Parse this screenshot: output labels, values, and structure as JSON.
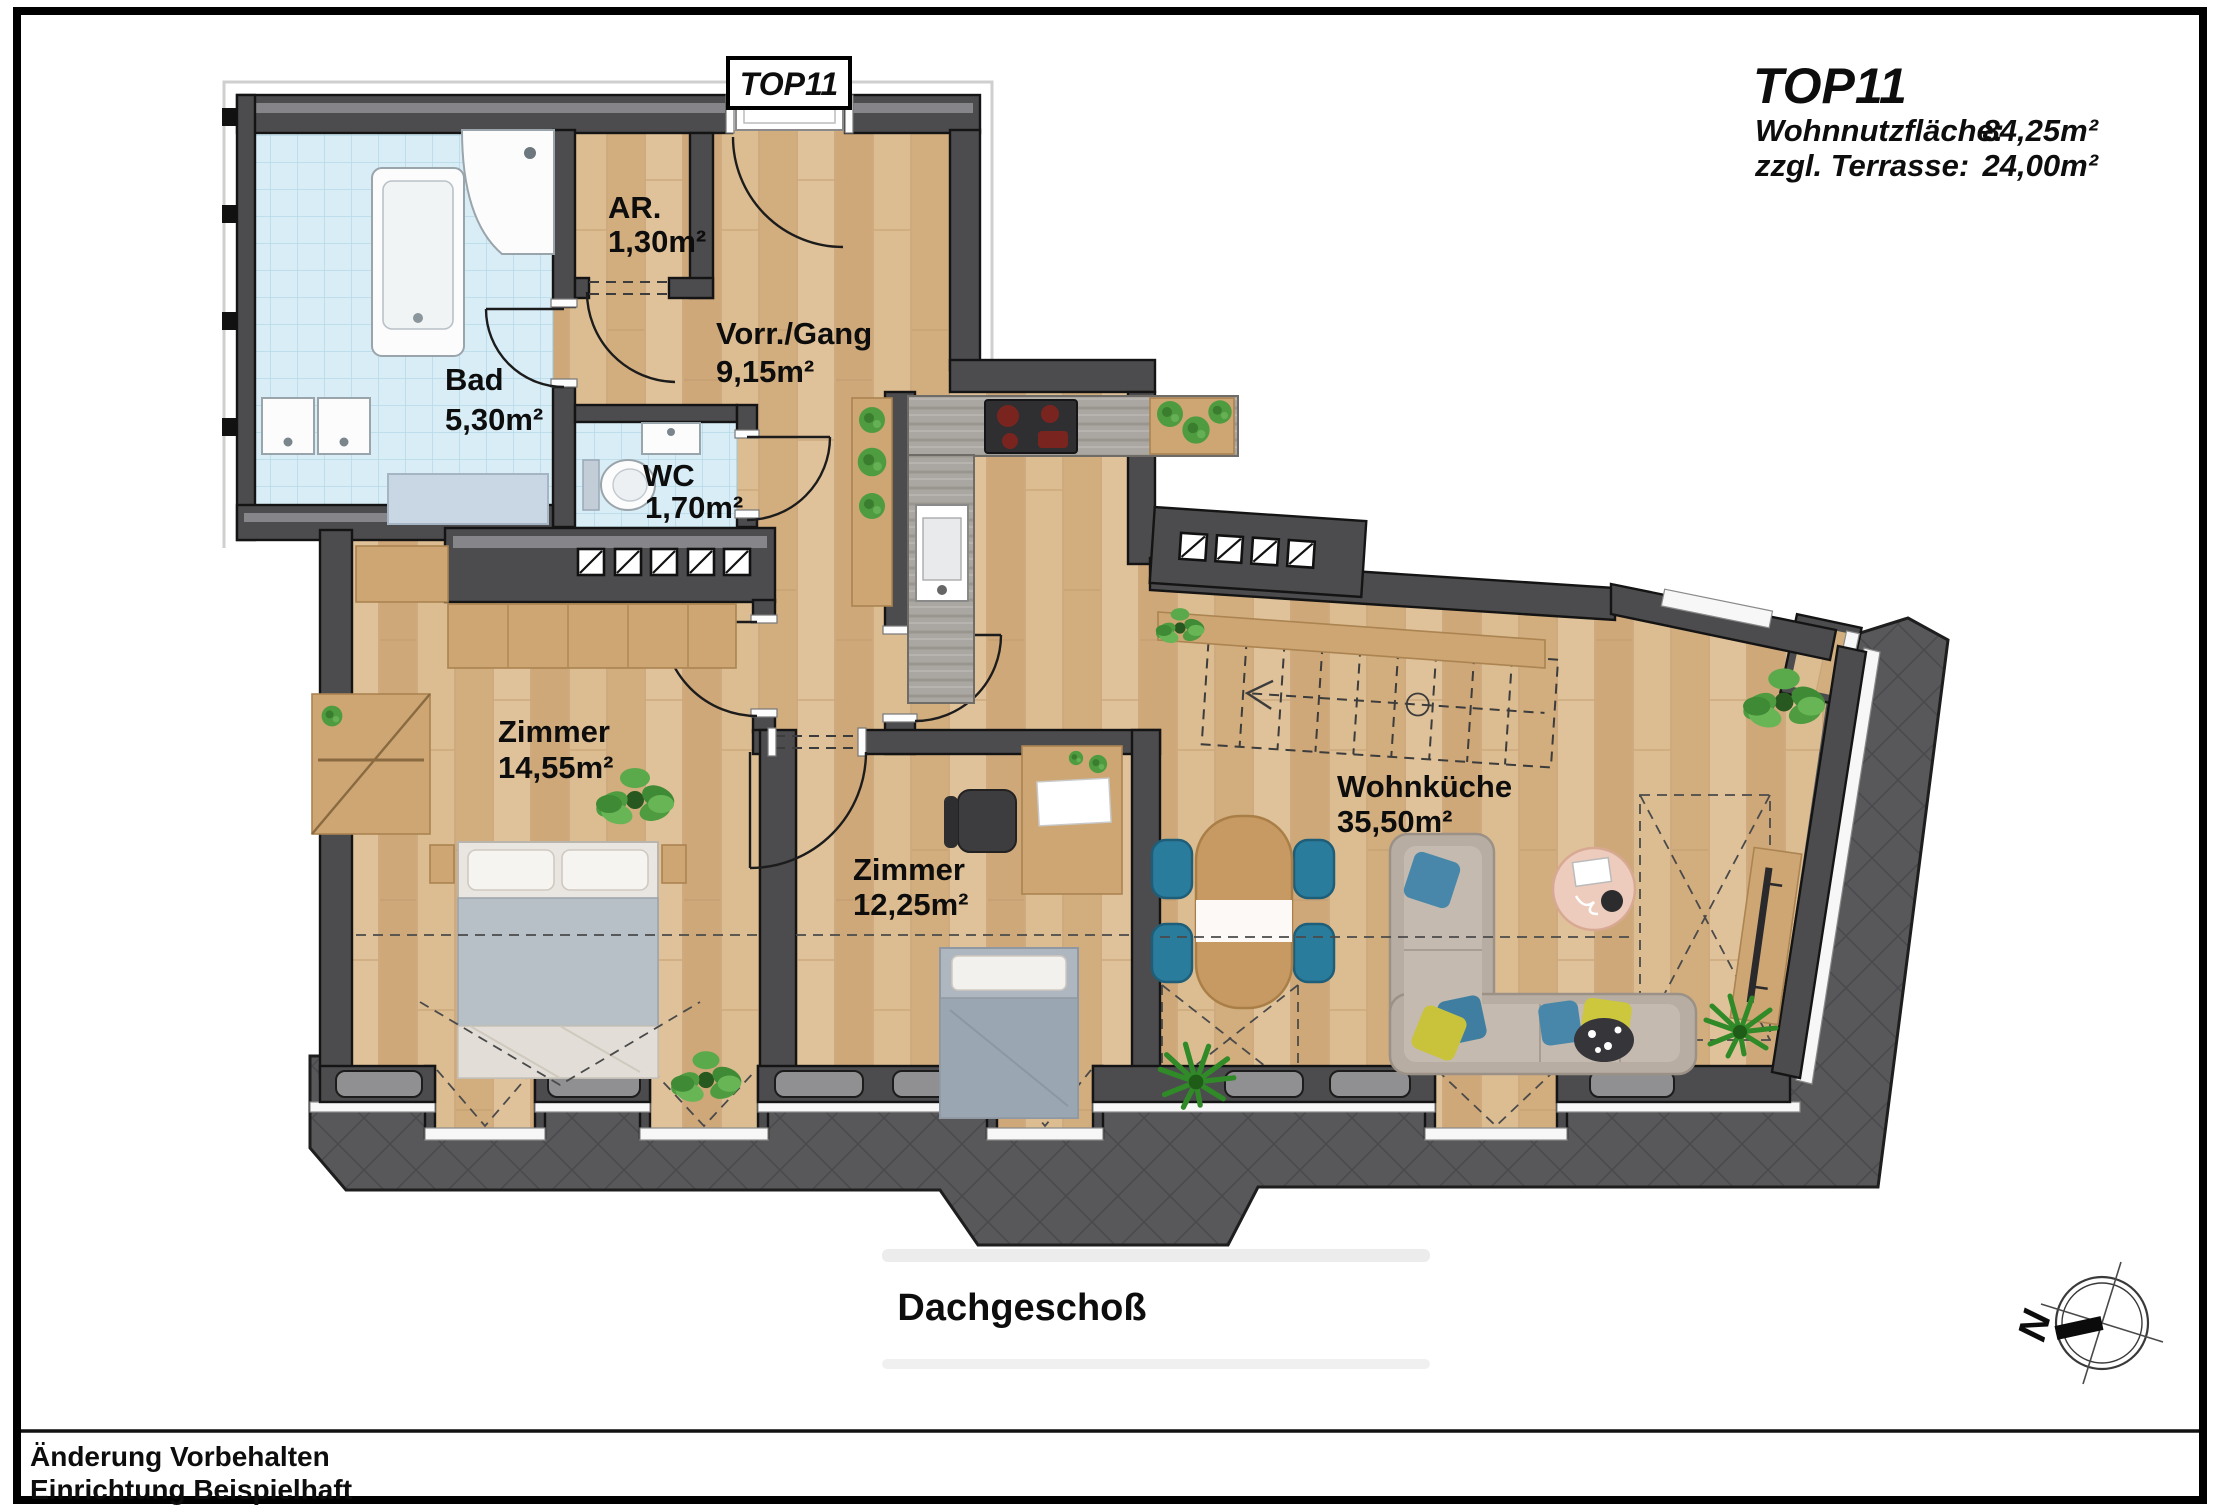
{
  "title_block": {
    "unit": "TOP11",
    "line1_label": "Wohnnutzfläche:",
    "line1_value": "84,25m²",
    "line2_label": "zzgl. Terrasse:",
    "line2_value": "24,00m²"
  },
  "unit_tag": "TOP11",
  "floor_label": "Dachgeschoß",
  "rooms": {
    "bad": {
      "name": "Bad",
      "area": "5,30m²"
    },
    "ar": {
      "name": "AR.",
      "area": "1,30m²"
    },
    "vorraum": {
      "name": "Vorr./Gang",
      "area": "9,15m²"
    },
    "wc": {
      "name": "WC",
      "area": "1,70m²"
    },
    "zimmer1": {
      "name": "Zimmer",
      "area": "14,55m²"
    },
    "zimmer2": {
      "name": "Zimmer",
      "area": "12,25m²"
    },
    "wohnkueche": {
      "name": "Wohnküche",
      "area": "35,50m²"
    }
  },
  "footer": {
    "line1": "Änderung Vorbehalten",
    "line2": "Einrichtung Beispielhaft"
  },
  "compass": {
    "north": "N"
  },
  "colors": {
    "wall": "#4c4c4e",
    "roof": "#58585b",
    "wood": "#d9b88c",
    "bath_tile": "#d8edf6",
    "furniture_wood": "#cda673",
    "sofa": "#b7ada3",
    "chair_blue": "#2a7c9c",
    "pillow_yellow": "#c9c33c"
  }
}
